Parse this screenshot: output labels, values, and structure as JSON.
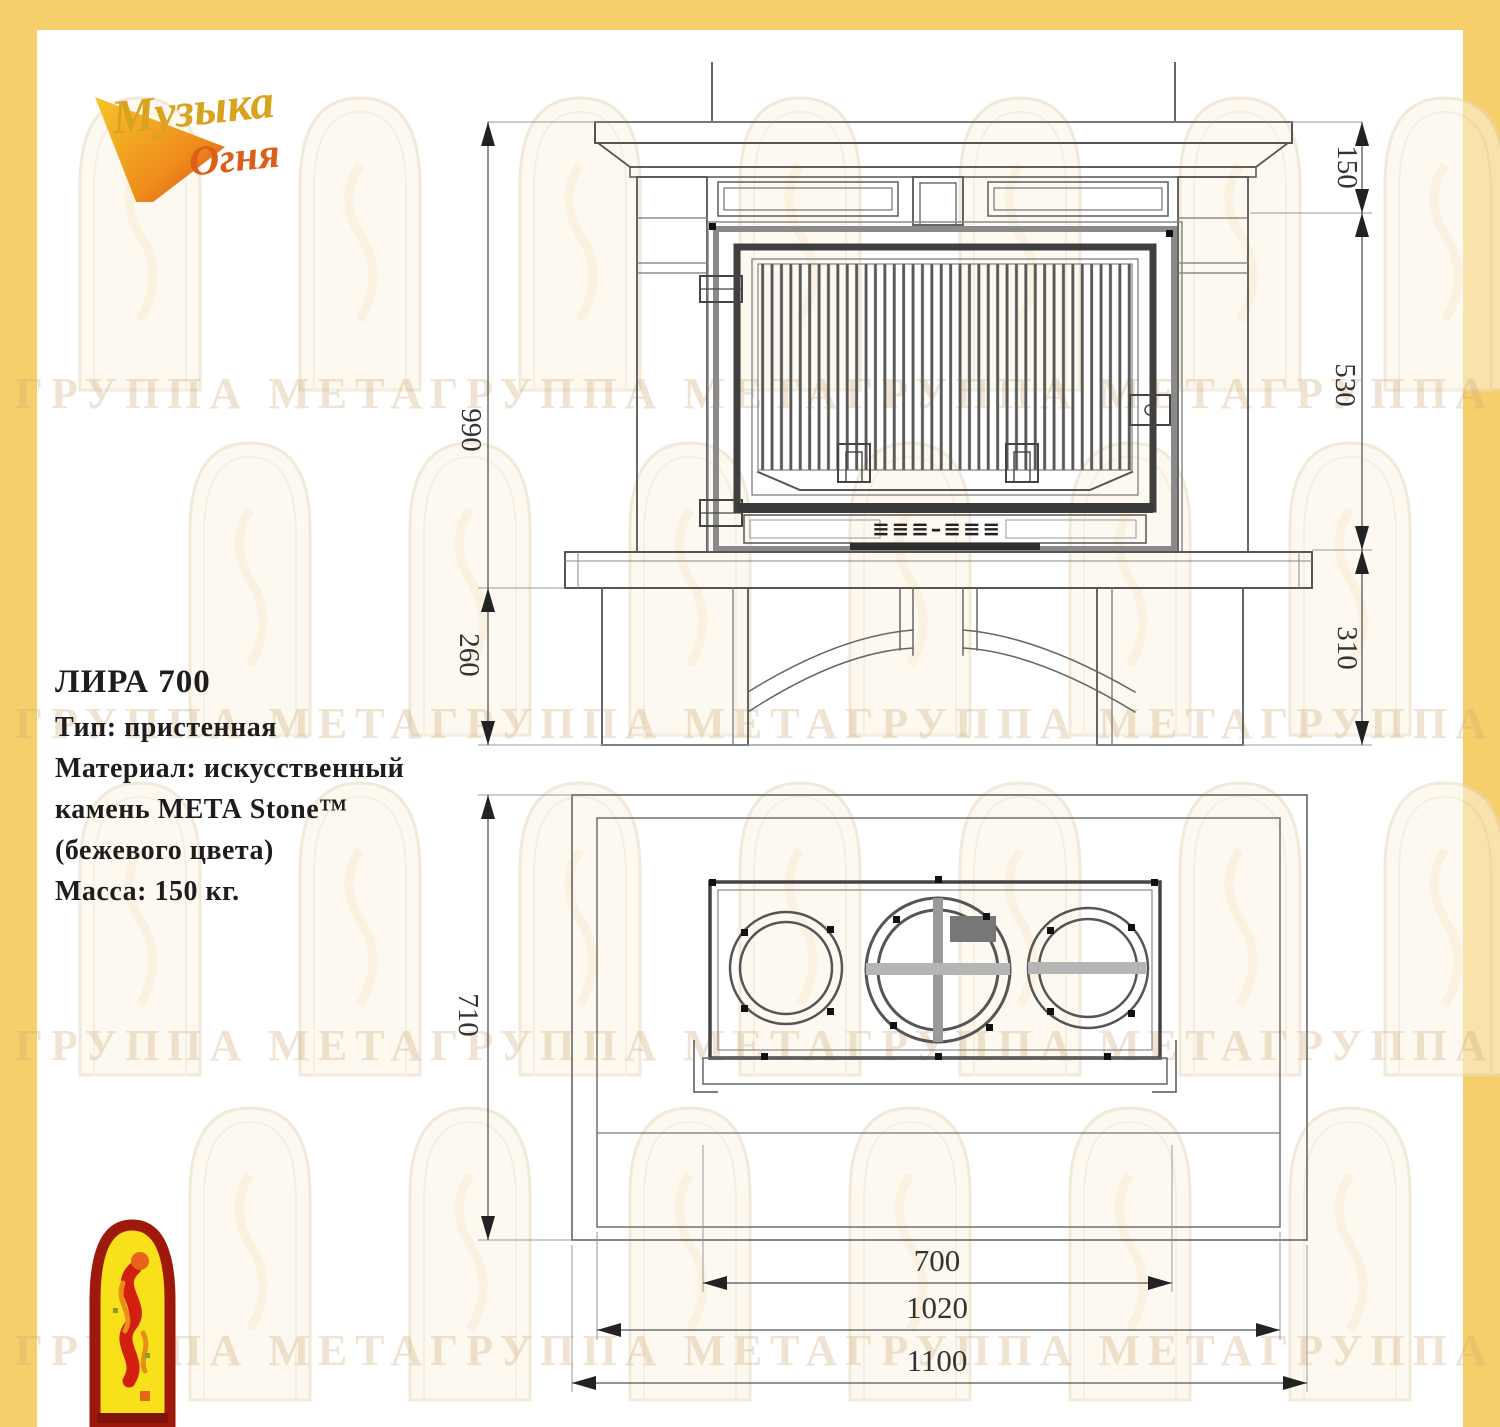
{
  "brand": {
    "line1": "Музыка",
    "line2": "Огня"
  },
  "watermark": {
    "row_text": "ГРУППА МЕТАГРУППА МЕТАГРУППА МЕТАГРУППА МЕТА"
  },
  "specs": {
    "title": "ЛИРА 700",
    "type": "Тип: пристенная",
    "material_1": "Материал: искусственный",
    "material_2": "камень МЕТА Stone™",
    "material_3": "(бежевого цвета)",
    "mass": "Масса: 150 кг."
  },
  "front_view": {
    "dim_mantel_height": "150",
    "dim_firebox_height": "530",
    "dim_total_height": "990",
    "dim_hearth_to_floor": "260",
    "dim_base_height": "310",
    "vent_glyphs": "≡≡≡–≡≡≡"
  },
  "plan_view": {
    "dim_depth": "710",
    "dim_firebox_width": "700",
    "dim_inner_width": "1020",
    "dim_overall_width": "1100"
  },
  "colors": {
    "border": "#F6CF6B",
    "line": "#555555",
    "accent_red": "#D31F0F",
    "accent_gold": "#D9A21F"
  }
}
